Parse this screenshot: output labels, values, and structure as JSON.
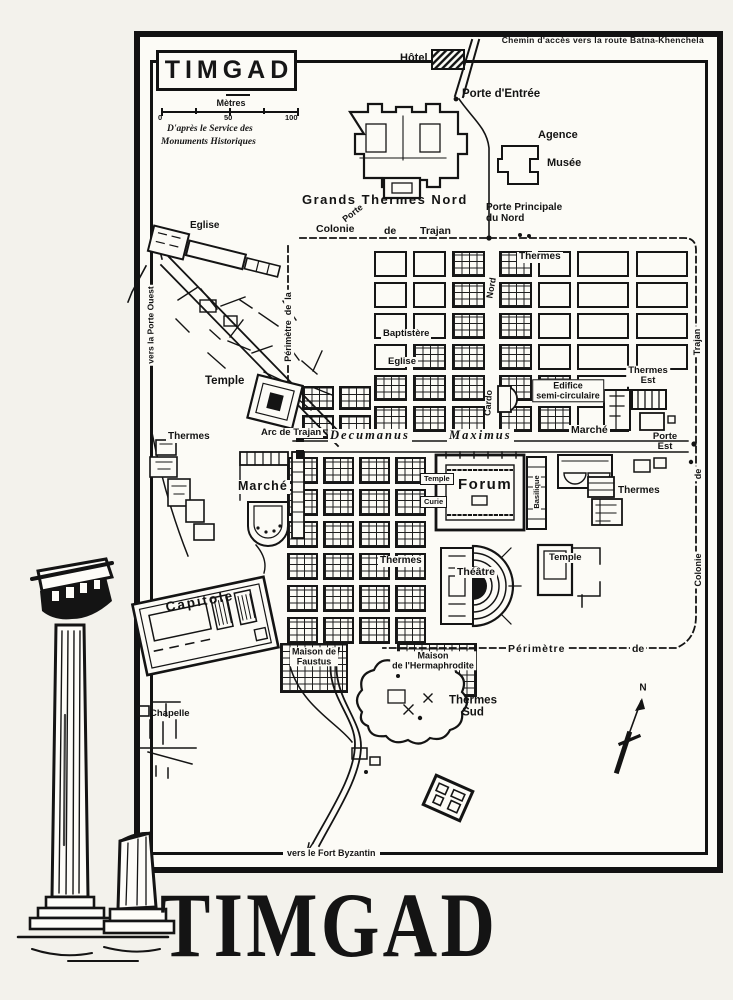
{
  "page": {
    "ink": "#141414",
    "paper": "#fcfbf6"
  },
  "frame": {
    "top_note": "Chemin d'accès vers la route Batna-Khenchela",
    "bottom_note": "vers le Fort Byzantin"
  },
  "legend": {
    "title": "TIMGAD",
    "unit": "Mètres",
    "scale_ticks": [
      "0",
      "50",
      "100"
    ],
    "attribution_line1": "D'après le Service des",
    "attribution_line2": "Monuments Historiques"
  },
  "big_title": "TIMGAD",
  "compass": {
    "label": "N"
  },
  "map": {
    "labels": [
      {
        "id": "label-hotel",
        "t": "Hôtel",
        "x": 400,
        "y": 53,
        "s": 11
      },
      {
        "id": "label-porte-entree",
        "t": "Porte d'Entrée",
        "x": 462,
        "y": 88,
        "s": 11.5
      },
      {
        "id": "label-agence",
        "t": "Agence",
        "x": 538,
        "y": 130,
        "s": 11
      },
      {
        "id": "label-musee",
        "t": "Musée",
        "x": 547,
        "y": 158,
        "s": 11
      },
      {
        "id": "label-grands-thermes-nord",
        "t": "Grands Thermes Nord",
        "x": 302,
        "y": 193,
        "s": 13,
        "ls": 1.5
      },
      {
        "id": "label-porte-gate",
        "t": "Porte",
        "x": 344,
        "y": 216,
        "s": 9,
        "r": -38
      },
      {
        "id": "label-colonie",
        "t": "Colonie",
        "x": 316,
        "y": 224,
        "s": 10.5
      },
      {
        "id": "label-de-trajan-mid",
        "t": "de",
        "x": 384,
        "y": 226,
        "s": 10.5
      },
      {
        "id": "label-trajan",
        "t": "Trajan",
        "x": 420,
        "y": 226,
        "s": 10.5
      },
      {
        "id": "label-porte-principale",
        "t": "Porte Principale\ndu Nord",
        "x": 486,
        "y": 203,
        "s": 10
      },
      {
        "id": "label-thermes-nord-grid",
        "t": "Thermes",
        "x": 517,
        "y": 252,
        "s": 10,
        "bg": 1
      },
      {
        "id": "label-eglise-nw",
        "t": "Eglise",
        "x": 190,
        "y": 221,
        "s": 10
      },
      {
        "id": "label-vers-porte-ouest",
        "t": "vers la Porte Ouest",
        "x": 151,
        "y": 325,
        "s": 8.5,
        "r": -90,
        "a": "c",
        "bg": 1
      },
      {
        "id": "label-perimetre-ouest",
        "t": "Périmètre  de  la",
        "x": 289,
        "y": 327,
        "s": 9,
        "r": -90,
        "a": "c",
        "bg": 1
      },
      {
        "id": "label-baptistere",
        "t": "Baptistère",
        "x": 381,
        "y": 329,
        "s": 9.5,
        "bg": 1
      },
      {
        "id": "label-eglise-centre",
        "t": "Eglise",
        "x": 386,
        "y": 357,
        "s": 9.5,
        "bg": 1
      },
      {
        "id": "label-temple-ouest",
        "t": "Temple",
        "x": 205,
        "y": 375,
        "s": 11.5
      },
      {
        "id": "label-edifice-semi-circulaire",
        "t": "Edifice\nsemi-circulaire",
        "x": 568,
        "y": 391,
        "s": 9,
        "a": "c",
        "box": 1
      },
      {
        "id": "label-thermes-est",
        "t": "Thermes\nEst",
        "x": 648,
        "y": 376,
        "s": 9.5,
        "a": "c",
        "bg": 1
      },
      {
        "id": "label-cardo-nord-vert",
        "t": "Nord",
        "x": 492,
        "y": 288,
        "s": 9,
        "r": -80,
        "a": "c"
      },
      {
        "id": "label-cardo-vert",
        "t": "Cardo",
        "x": 489,
        "y": 403,
        "s": 9,
        "r": -86,
        "a": "c"
      },
      {
        "id": "label-arc-de-trajan",
        "t": "Arc de Trajan",
        "x": 259,
        "y": 428,
        "s": 9.5,
        "bg": 1
      },
      {
        "id": "label-decumanus",
        "t": "Decumanus",
        "x": 328,
        "y": 429,
        "s": 12.5,
        "i": 1,
        "ls": 2,
        "f": "serif",
        "bg": 1
      },
      {
        "id": "label-maximus",
        "t": "Maximus",
        "x": 447,
        "y": 429,
        "s": 12.5,
        "i": 1,
        "ls": 2,
        "f": "serif",
        "bg": 1
      },
      {
        "id": "label-marche-est",
        "t": "Marché",
        "x": 569,
        "y": 425,
        "s": 10.5,
        "bg": 1
      },
      {
        "id": "label-porte-est",
        "t": "Porte\nEst",
        "x": 665,
        "y": 442,
        "s": 9.5,
        "a": "c"
      },
      {
        "id": "label-thermes-ouest",
        "t": "Thermes",
        "x": 166,
        "y": 432,
        "s": 10,
        "bg": 1
      },
      {
        "id": "label-marche-ouest",
        "t": "Marché",
        "x": 236,
        "y": 480,
        "s": 12.5,
        "ls": 1,
        "bg": 1
      },
      {
        "id": "label-temple-forum",
        "t": "Temple",
        "x": 420,
        "y": 473,
        "s": 7.5,
        "box": 1
      },
      {
        "id": "label-curie",
        "t": "Curie",
        "x": 420,
        "y": 496,
        "s": 7.5,
        "box": 1
      },
      {
        "id": "label-forum",
        "t": "Forum",
        "x": 458,
        "y": 477,
        "s": 15,
        "ls": 1.5
      },
      {
        "id": "label-basilique-vert",
        "t": "Basilique",
        "x": 537,
        "y": 492,
        "s": 7.5,
        "r": -90,
        "a": "c",
        "bg": 1
      },
      {
        "id": "label-thermes-est2",
        "t": "Thermes",
        "x": 616,
        "y": 486,
        "s": 10,
        "bg": 1
      },
      {
        "id": "label-thermes-sud-grid",
        "t": "Thermes",
        "x": 378,
        "y": 556,
        "s": 10,
        "bg": 1
      },
      {
        "id": "label-theatre",
        "t": "Théâtre",
        "x": 455,
        "y": 567,
        "s": 10.5,
        "bg": 1
      },
      {
        "id": "label-temple-se",
        "t": "Temple",
        "x": 547,
        "y": 553,
        "s": 9.5,
        "bg": 1
      },
      {
        "id": "label-capitole",
        "t": "Capitole",
        "x": 200,
        "y": 602,
        "s": 13.5,
        "ls": 2,
        "r": -10,
        "a": "c"
      },
      {
        "id": "label-maison-de-faustus",
        "t": "Maison de\nFaustus",
        "x": 314,
        "y": 657,
        "s": 9,
        "a": "c",
        "bg": 1
      },
      {
        "id": "label-maison-hermaphrodite",
        "t": "Maison\nde l'Hermaphrodite",
        "x": 433,
        "y": 661,
        "s": 9,
        "a": "c",
        "bg": 1
      },
      {
        "id": "label-perimetre-sud",
        "t": "Périmètre",
        "x": 506,
        "y": 644,
        "s": 10.5,
        "ls": 1,
        "bg": 1
      },
      {
        "id": "label-de-sud",
        "t": "de",
        "x": 630,
        "y": 644,
        "s": 10.5,
        "bg": 1
      },
      {
        "id": "label-chapelle",
        "t": "Chapelle",
        "x": 150,
        "y": 709,
        "s": 9.5
      },
      {
        "id": "label-thermes-sud",
        "t": "Thermes\nSud",
        "x": 473,
        "y": 707,
        "s": 11.5,
        "a": "c"
      },
      {
        "id": "label-compass-n",
        "t": "N",
        "x": 643,
        "y": 689,
        "s": 10,
        "a": "c"
      },
      {
        "id": "label-trajan-vert",
        "t": "Trajan",
        "x": 698,
        "y": 342,
        "s": 9,
        "r": -90,
        "a": "c",
        "bg": 1
      },
      {
        "id": "label-de-vert",
        "t": "de",
        "x": 699,
        "y": 474,
        "s": 9,
        "r": -90,
        "a": "c",
        "bg": 1
      },
      {
        "id": "label-colonie-vert",
        "t": "Colonie",
        "x": 699,
        "y": 570,
        "s": 9,
        "r": -90,
        "a": "c",
        "bg": 1
      }
    ],
    "grids": [
      {
        "name": "insulae-north-west",
        "x": 374,
        "y": 251,
        "cols": 3,
        "rows": 6,
        "cw": 33,
        "ch": 26,
        "gx": 6,
        "gy": 5,
        "detail": [
          "0,2",
          "1,2",
          "2,2",
          "3,1",
          "3,2",
          "4,0",
          "4,1",
          "4,2",
          "5,0",
          "5,1",
          "5,2"
        ]
      },
      {
        "name": "insulae-north-mid",
        "x": 499,
        "y": 251,
        "cols": 2,
        "rows": 6,
        "cw": 33,
        "ch": 26,
        "gx": 6,
        "gy": 5,
        "detail": [
          "0,0",
          "1,0",
          "2,0",
          "3,0",
          "4,0",
          "4,1",
          "5,0",
          "5,1"
        ]
      },
      {
        "name": "insulae-north-east",
        "x": 577,
        "y": 251,
        "cols": 2,
        "rows": 6,
        "cw": 52,
        "ch": 26,
        "gx": 7,
        "gy": 5,
        "detail": [],
        "skip": [
          "4,1",
          "5,1"
        ]
      },
      {
        "name": "insulae-west-annex",
        "x": 302,
        "y": 386,
        "cols": 2,
        "rows": 2,
        "cw": 32,
        "ch": 24,
        "gx": 5,
        "gy": 5,
        "detail": "all"
      },
      {
        "name": "insulae-south",
        "x": 287,
        "y": 457,
        "cols": 4,
        "rows": 6,
        "cw": 31,
        "ch": 27,
        "gx": 5,
        "gy": 5,
        "detail": "all"
      },
      {
        "name": "maison-faustus-block",
        "x": 280,
        "y": 643,
        "cols": 1,
        "rows": 1,
        "cw": 68,
        "ch": 50,
        "gx": 0,
        "gy": 0,
        "detail": "all"
      },
      {
        "name": "maison-hermaphrodite-block",
        "x": 397,
        "y": 643,
        "cols": 1,
        "rows": 1,
        "cw": 80,
        "ch": 54,
        "gx": 0,
        "gy": 0,
        "detail": "all"
      }
    ]
  }
}
